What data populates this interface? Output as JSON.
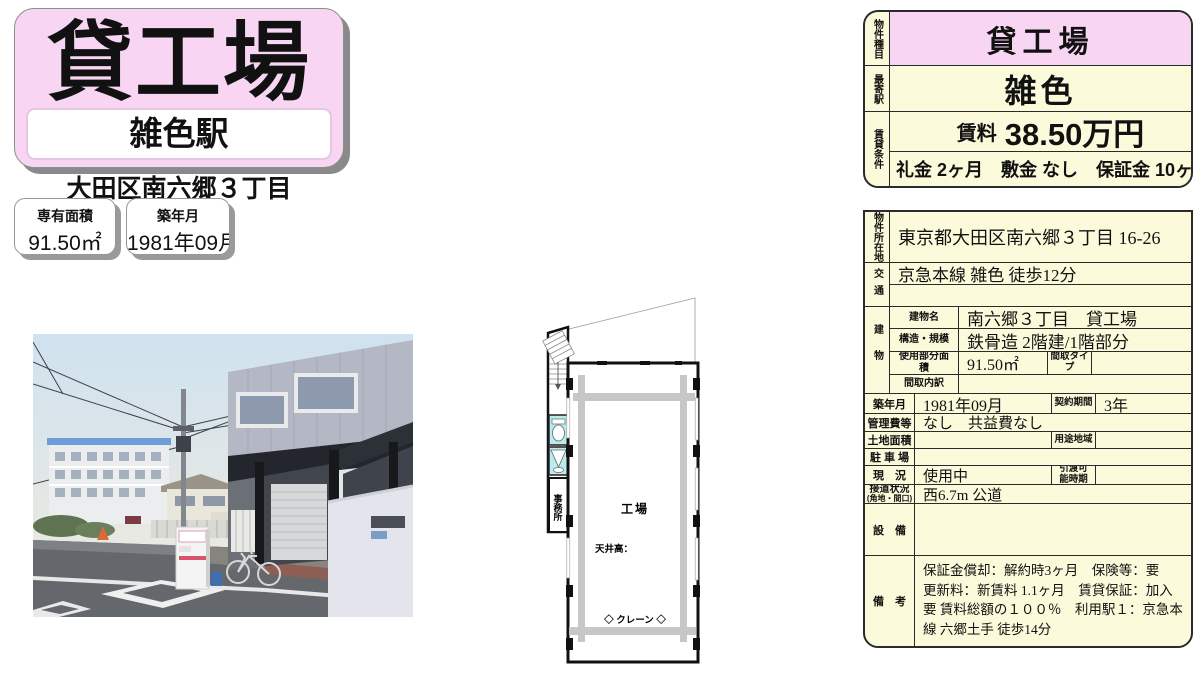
{
  "colors": {
    "accent_pink": "#f8d6f3",
    "table_cream": "#fbfbdb",
    "table_border": "#2b2b2b",
    "plan_cyan": "#b9ecec",
    "plan_crane_gray": "#c7c7c7",
    "shadow_gray": "#8a8a8a"
  },
  "brand": {
    "property_type": "貸工場",
    "station": "雑色駅",
    "address": "大田区南六郷３丁目",
    "area_label": "専有面積",
    "area_value": "91.50㎡",
    "built_label": "築年月",
    "built_value": "1981年09月"
  },
  "summary": {
    "type_label": "物件種目",
    "type_value": "貸工場",
    "station_label": "最寄駅",
    "station_value": "雑色",
    "terms_label": "賃貸条件",
    "rent_label": "賃料",
    "rent_value": "38.50万円",
    "terms_line": "礼金 2ヶ月　敷金 なし　保証金 10ヶ月"
  },
  "details": {
    "location_label": "物件所在地",
    "location": "東京都大田区南六郷３丁目 16-26",
    "access_label": "交通",
    "access_line1": "京急本線 雑色 徒歩12分",
    "access_line2": "",
    "building_label": "建物",
    "building_name_label": "建物名",
    "building_name": "南六郷３丁目　貸工場",
    "structure_label": "構造・規模",
    "structure": "鉄骨造 2階建/1階部分",
    "used_area_label": "使用部分面積",
    "used_area": "91.50㎡",
    "layout_type_label": "間取タイプ",
    "layout_type": "",
    "layout_detail_label": "間取内訳",
    "layout_detail": "",
    "built_label": "築年月",
    "built": "1981年09月",
    "contract_label": "契約期間",
    "contract": "3年",
    "mgmt_label": "管理費等",
    "mgmt": "なし　共益費なし",
    "land_label": "土地面積",
    "land": "",
    "zone_label": "用途地域",
    "zone": "",
    "parking_label": "駐 車 場",
    "parking": "",
    "status_label": "現　況",
    "status": "使用中",
    "handover_label": "引渡可能時期",
    "handover": "",
    "road_label": "接道状況",
    "road_sublabel": "(角地・間口)",
    "road": "西6.7m 公道",
    "equipment_label": "設　備",
    "equipment": "",
    "remarks_label": "備　考",
    "remarks": "保証金償却：解約時3ヶ月　保険等：要　更新料：新賃料 1.1ヶ月　賃貸保証：加入要 賃料総額の１００％　利用駅１：京急本線 六郷土手 徒歩14分"
  },
  "floorplan": {
    "room": "工場",
    "ceiling": "天井高：",
    "crane": "◇ クレーン ◇",
    "office": "事務所"
  }
}
